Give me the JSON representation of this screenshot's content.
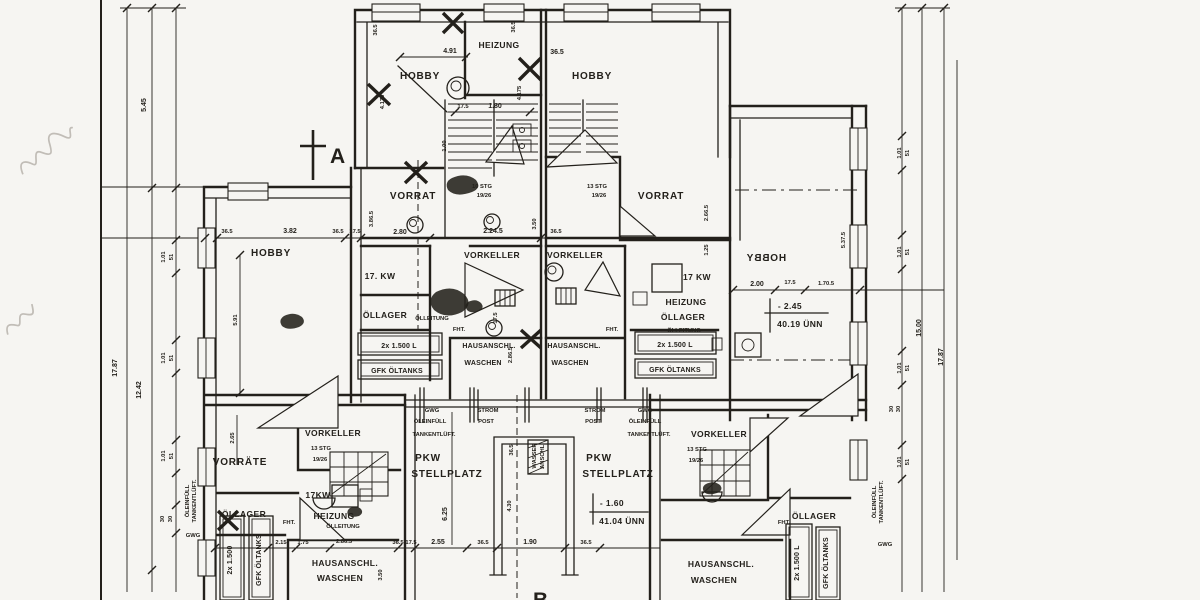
{
  "document": {
    "kind": "scanned basement floor plan (Kellergeschoss), black ink on aged paper",
    "paper_color": "#f3f2ef",
    "ink_color": "#26231e"
  },
  "sections": {
    "a": "A",
    "b": "B"
  },
  "rooms": {
    "hobby": "HOBBY",
    "heizung": "HEIZUNG",
    "vorrat": "VORRAT",
    "vorraete": "VORRÄTE",
    "vorkeller": "VORKELLER",
    "oellager": "ÖLLAGER",
    "pkw": "PKW",
    "stellplatz": "STELLPLATZ",
    "hausanschl": "HAUSANSCHL.",
    "waschen": "WASCHEN"
  },
  "equipment": {
    "kw": "17 KW",
    "kw_dotted": "17. KW",
    "kw_tight": "17KW",
    "heizung": "HEIZUNG",
    "oelleitung": "ÖLLEITUNG",
    "tanks": "2x 1.500 L",
    "tanks_short": "2x 1.500",
    "gfk_tanks": "GFK ÖLTANKS",
    "fht": "FHT.",
    "gwg": "GWG",
    "oeleinfuell": "ÖLEINFÜLL",
    "tankentlueft": "TANKENTLÜFT.",
    "strom": "STROM",
    "post": "POST",
    "wasser": "WASSER",
    "anschl": "ANSCHL."
  },
  "stairs": {
    "stg13": "13 STG",
    "stg10": "10 STG",
    "riser": "19/26"
  },
  "levels": {
    "hobby_value": "- 2.45",
    "hobby_datum": "40.19 ÜNN",
    "pkw_value": "- 1.60",
    "pkw_datum": "41.04 ÜNN"
  },
  "dims": {
    "d1787": "17.87",
    "d1242": "12.42",
    "d1500": "15.00",
    "d545": "5.45",
    "d101": "1.01",
    "d51": "51",
    "d30": "30",
    "d365": "36.5",
    "d175": "17.5",
    "d491": "4.91",
    "d4175": "4.175",
    "d180": "1.80",
    "d100": "1.00",
    "d382": "3.82",
    "d280": "2.80",
    "d3865": "3.86.5",
    "d2245": "2.24.5",
    "d350": "3.50",
    "d2865": "2.86.5",
    "d591": "5.91",
    "d265": "2.65",
    "d200": "2.00",
    "d1705": "1.70.5",
    "d5375": "5.37.5",
    "d2665": "2.66.5",
    "d125": "1.25",
    "d625": "6.25",
    "d430": "4.30",
    "d255": "2.55",
    "d190": "1.90",
    "d215": "2.15",
    "d175b": "1.75"
  }
}
